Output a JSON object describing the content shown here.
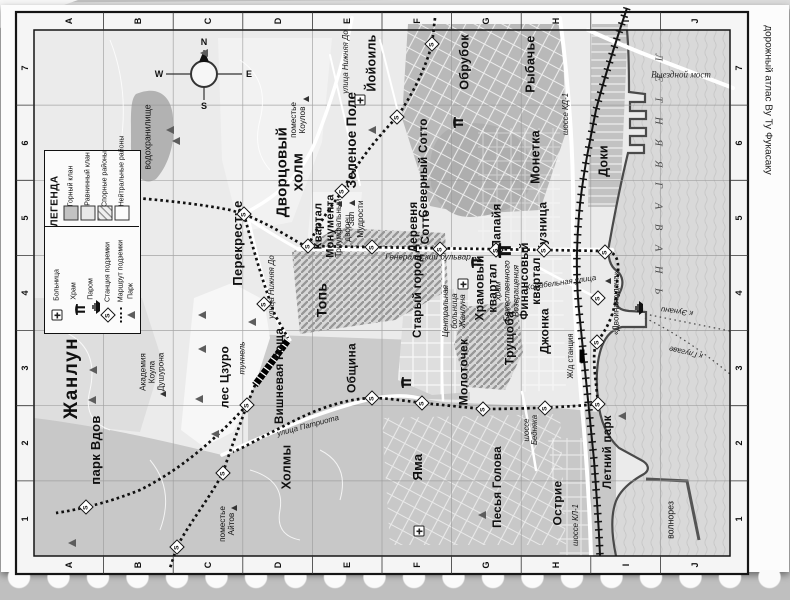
{
  "page": {
    "atlas_caption": "дорожный атлас Ву Ту Фукасаку"
  },
  "grid": {
    "cols": [
      "A",
      "B",
      "C",
      "D",
      "E",
      "F",
      "G",
      "H",
      "I",
      "J"
    ],
    "rows": [
      "7",
      "6",
      "5",
      "4",
      "3",
      "2",
      "1"
    ]
  },
  "compass": {
    "n": "N",
    "e": "E",
    "s": "S",
    "w": "W"
  },
  "sea": {
    "name": "Л Е Т Н Я Я   Г А В А Н Ь"
  },
  "legend": {
    "title": "ЛЕГЕНДА",
    "areas": [
      {
        "id": "mountain-clan",
        "label": "Горный клан",
        "swatch": "#c2c2c2"
      },
      {
        "id": "plain-clan",
        "label": "Равнинный клан",
        "swatch": "#e8e8e8"
      },
      {
        "id": "disputed-districts",
        "label": "Спорные районы",
        "swatch": "hatch"
      },
      {
        "id": "neutral-districts",
        "label": "Нейтральные районы",
        "swatch": "#fbfbfb"
      }
    ],
    "symbols": [
      {
        "id": "hospital",
        "label": "Больница"
      },
      {
        "id": "temple",
        "label": "Храм"
      },
      {
        "id": "ferry",
        "label": "Паром"
      },
      {
        "id": "metro-station",
        "label": "Станция подземки"
      },
      {
        "id": "metro-route",
        "label": "Маршрут подземки"
      },
      {
        "id": "park",
        "label": "Парк"
      }
    ]
  },
  "map": {
    "labels": [
      {
        "id": "city-title",
        "text": "Жанлун",
        "x": 72,
        "y": 378,
        "size": 19,
        "cls": "title"
      },
      {
        "id": "district-yoyoil",
        "text": "Йойоиль",
        "x": 372,
        "y": 63,
        "size": 12.5,
        "cls": "d"
      },
      {
        "id": "district-palace-hill",
        "text": "Дворцовый\nхолм",
        "x": 290,
        "y": 172,
        "size": 15,
        "cls": "d"
      },
      {
        "id": "district-green-field",
        "text": "Зеленое Поле",
        "x": 352,
        "y": 140,
        "size": 13.5,
        "cls": "d"
      },
      {
        "id": "district-obrubok",
        "text": "Обрубок",
        "x": 465,
        "y": 62,
        "size": 12.5,
        "cls": "d"
      },
      {
        "id": "district-rybachye",
        "text": "Рыбачье",
        "x": 531,
        "y": 64,
        "size": 12.5,
        "cls": "d"
      },
      {
        "id": "district-north-sotto",
        "text": "Северный Сотто",
        "x": 424,
        "y": 168,
        "size": 11.5,
        "cls": "d"
      },
      {
        "id": "district-monetka",
        "text": "Монетка",
        "x": 536,
        "y": 157,
        "size": 12.5,
        "cls": "d"
      },
      {
        "id": "district-doki",
        "text": "Доки",
        "x": 604,
        "y": 161,
        "size": 12.5,
        "cls": "d"
      },
      {
        "id": "district-sotto-village",
        "text": "Деревня\nСотто",
        "x": 420,
        "y": 227,
        "size": 11.5,
        "cls": "d"
      },
      {
        "id": "district-papaya",
        "text": "Папайя",
        "x": 497,
        "y": 226,
        "size": 12,
        "cls": "d"
      },
      {
        "id": "district-kuznitsa",
        "text": "Кузница",
        "x": 543,
        "y": 227,
        "size": 12,
        "cls": "d"
      },
      {
        "id": "district-perekrestye",
        "text": "Перекрестье",
        "x": 238,
        "y": 243,
        "size": 13,
        "cls": "d"
      },
      {
        "id": "district-monument-quarter",
        "text": "Квартал\nМонумента",
        "x": 325,
        "y": 226,
        "size": 11,
        "cls": "d"
      },
      {
        "id": "district-top",
        "text": "Топь",
        "x": 322,
        "y": 300,
        "size": 14,
        "cls": "d"
      },
      {
        "id": "district-old-town",
        "text": "Старый город",
        "x": 418,
        "y": 296,
        "size": 11.5,
        "cls": "d"
      },
      {
        "id": "district-temple-quarter",
        "text": "Храмовый\nквартал",
        "x": 486,
        "y": 288,
        "size": 12,
        "cls": "d"
      },
      {
        "id": "district-finance-quarter",
        "text": "Финансовый\nквартал",
        "x": 531,
        "y": 281,
        "size": 11.5,
        "cls": "d"
      },
      {
        "id": "district-trushchoba",
        "text": "Трущоба",
        "x": 510,
        "y": 338,
        "size": 12,
        "cls": "d"
      },
      {
        "id": "district-dzhonka",
        "text": "Джонка",
        "x": 545,
        "y": 331,
        "size": 12,
        "cls": "d"
      },
      {
        "id": "district-molotochek",
        "text": "Молоточек",
        "x": 464,
        "y": 372,
        "size": 12,
        "cls": "d"
      },
      {
        "id": "district-obshchina",
        "text": "Община",
        "x": 352,
        "y": 368,
        "size": 12,
        "cls": "d"
      },
      {
        "id": "district-cherry-grove",
        "text": "Вишневая Роща",
        "x": 280,
        "y": 376,
        "size": 11.5,
        "cls": "d"
      },
      {
        "id": "district-tszuro-forest",
        "text": "лес Цзуро",
        "x": 225,
        "y": 377,
        "size": 12,
        "cls": "d"
      },
      {
        "id": "district-widows-park",
        "text": "парк Вдов",
        "x": 96,
        "y": 450,
        "size": 13,
        "cls": "d"
      },
      {
        "id": "district-kholmy",
        "text": "Холмы",
        "x": 287,
        "y": 467,
        "size": 12.5,
        "cls": "d"
      },
      {
        "id": "district-yama",
        "text": "Яма",
        "x": 418,
        "y": 467,
        "size": 13,
        "cls": "d"
      },
      {
        "id": "district-pesya-golova",
        "text": "Песья Голова",
        "x": 498,
        "y": 487,
        "size": 11.5,
        "cls": "d"
      },
      {
        "id": "district-ostrie",
        "text": "Острие",
        "x": 558,
        "y": 503,
        "size": 12,
        "cls": "d"
      },
      {
        "id": "district-summer-park",
        "text": "Летний парк",
        "x": 608,
        "y": 452,
        "size": 11.5,
        "cls": "d"
      },
      {
        "id": "poi-kouls-estate",
        "text": "поместье\nКоулов",
        "x": 299,
        "y": 120,
        "size": 8.2,
        "cls": "p"
      },
      {
        "id": "poi-academy",
        "text": "Академия\nКоула\nДушурона",
        "x": 153,
        "y": 372,
        "size": 8.2,
        "cls": "p"
      },
      {
        "id": "poi-ayts-estate",
        "text": "поместье\nАйтов",
        "x": 228,
        "y": 524,
        "size": 8.2,
        "cls": "p"
      },
      {
        "id": "poi-triumph-palace",
        "text": "Триумфальный\nдворец",
        "x": 344,
        "y": 228,
        "size": 8.2,
        "cls": "p"
      },
      {
        "id": "poi-wisdom-hall",
        "text": "Зал\nМудрости",
        "x": 357,
        "y": 219,
        "size": 8.2,
        "cls": "p"
      },
      {
        "id": "poi-divine-return-temple",
        "text": "храм\nБожественного\nВозвращения",
        "x": 508,
        "y": 291,
        "size": 8.2,
        "cls": "p pi"
      },
      {
        "id": "poi-central-hospital",
        "text": "Центральная\nбольница\nЖанлуна",
        "x": 455,
        "y": 311,
        "size": 8,
        "cls": "p pi"
      },
      {
        "id": "poi-double-luck",
        "text": "«Двойная удача»",
        "x": 617,
        "y": 303,
        "size": 8,
        "cls": "p"
      },
      {
        "id": "poi-reservoir",
        "text": "водохранилище",
        "x": 148,
        "y": 137,
        "size": 8.8,
        "cls": "p"
      },
      {
        "id": "poi-breakwater",
        "text": "волнорез",
        "x": 671,
        "y": 520,
        "size": 8.8,
        "cls": "p"
      },
      {
        "id": "poi-tunnel",
        "text": "туннель",
        "x": 243,
        "y": 358,
        "size": 8.2,
        "cls": "st"
      },
      {
        "id": "poi-rail-station",
        "text": "Ж/д станция",
        "x": 571,
        "y": 356,
        "size": 7.8,
        "cls": "p"
      },
      {
        "id": "street-nizhnyaya-do-north",
        "text": "улица Нижняя До",
        "x": 346,
        "y": 62,
        "size": 7.8,
        "cls": "st"
      },
      {
        "id": "street-nizhnyaya-do-south",
        "text": "улица Нижняя До",
        "x": 272,
        "y": 287,
        "size": 7.8,
        "cls": "st"
      },
      {
        "id": "street-kd-1",
        "text": "шоссе КД-1",
        "x": 566,
        "y": 114,
        "size": 7.8,
        "cls": "st"
      },
      {
        "id": "street-kl-1",
        "text": "шоссе КЛ-1",
        "x": 576,
        "y": 525,
        "size": 7.8,
        "cls": "st"
      },
      {
        "id": "street-bednyaka",
        "text": "шоссе\nБедняка",
        "x": 531,
        "y": 430,
        "size": 7.8,
        "cls": "st"
      },
      {
        "id": "street-patriota",
        "text": "улица Патриота",
        "x": 308,
        "y": 426,
        "size": 7.8,
        "cls": "st",
        "rot": -15
      },
      {
        "id": "street-general-blvd",
        "text": "Генеральский бульвар",
        "x": 428,
        "y": 258,
        "size": 8.2,
        "cls": "st",
        "rot": 0
      },
      {
        "id": "street-korabelnaya",
        "text": "Корабельная улица",
        "x": 561,
        "y": 283,
        "size": 7.8,
        "cls": "st",
        "rot": -8
      },
      {
        "id": "poi-exit-bridge",
        "text": "Выездной мост",
        "x": 681,
        "y": 75,
        "size": 9,
        "cls": "sti",
        "rot": 0
      },
      {
        "id": "ferry-to-eunani",
        "text": "к Эунани",
        "x": 677,
        "y": 311,
        "size": 7.8,
        "cls": "st",
        "rot": 187
      },
      {
        "id": "ferry-to-glugave",
        "text": "к Глугаве",
        "x": 686,
        "y": 352,
        "size": 7.8,
        "cls": "st",
        "rot": 193
      }
    ],
    "metro_stations": [
      [
        244,
        214
      ],
      [
        308,
        246
      ],
      [
        372,
        247
      ],
      [
        440,
        249
      ],
      [
        496,
        250
      ],
      [
        544,
        250
      ],
      [
        605,
        252
      ],
      [
        598,
        298
      ],
      [
        597,
        342
      ],
      [
        598,
        404
      ],
      [
        545,
        408
      ],
      [
        483,
        409
      ],
      [
        422,
        403
      ],
      [
        372,
        398
      ],
      [
        342,
        191
      ],
      [
        397,
        117
      ],
      [
        432,
        44
      ],
      [
        264,
        304
      ],
      [
        247,
        405
      ],
      [
        223,
        473
      ],
      [
        177,
        547
      ],
      [
        86,
        507
      ]
    ],
    "park_trees": [
      [
        204,
        53
      ],
      [
        372,
        130
      ],
      [
        170,
        130
      ],
      [
        176,
        141
      ],
      [
        622,
        416
      ],
      [
        482,
        515
      ],
      [
        93,
        370
      ],
      [
        92,
        400
      ],
      [
        202,
        349
      ],
      [
        252,
        322
      ],
      [
        202,
        315
      ],
      [
        199,
        399
      ],
      [
        215,
        434
      ],
      [
        72,
        543
      ]
    ],
    "poi_markers": [
      [
        306,
        99
      ],
      [
        339,
        204
      ],
      [
        352,
        203
      ],
      [
        163,
        394
      ],
      [
        234,
        508
      ],
      [
        608,
        281
      ]
    ],
    "temples": [
      {
        "x": 452,
        "y": 128,
        "s": 1
      },
      {
        "x": 470,
        "y": 268,
        "s": 1
      },
      {
        "x": 496,
        "y": 258,
        "s": 1.35
      },
      {
        "x": 400,
        "y": 388,
        "s": 1
      }
    ],
    "hospitals": [
      [
        360,
        100
      ],
      [
        463,
        284
      ],
      [
        419,
        531
      ]
    ],
    "ferry_icon": {
      "x": 634,
      "y": 316
    },
    "rail_station_box": {
      "x": 582,
      "y": 356
    }
  }
}
